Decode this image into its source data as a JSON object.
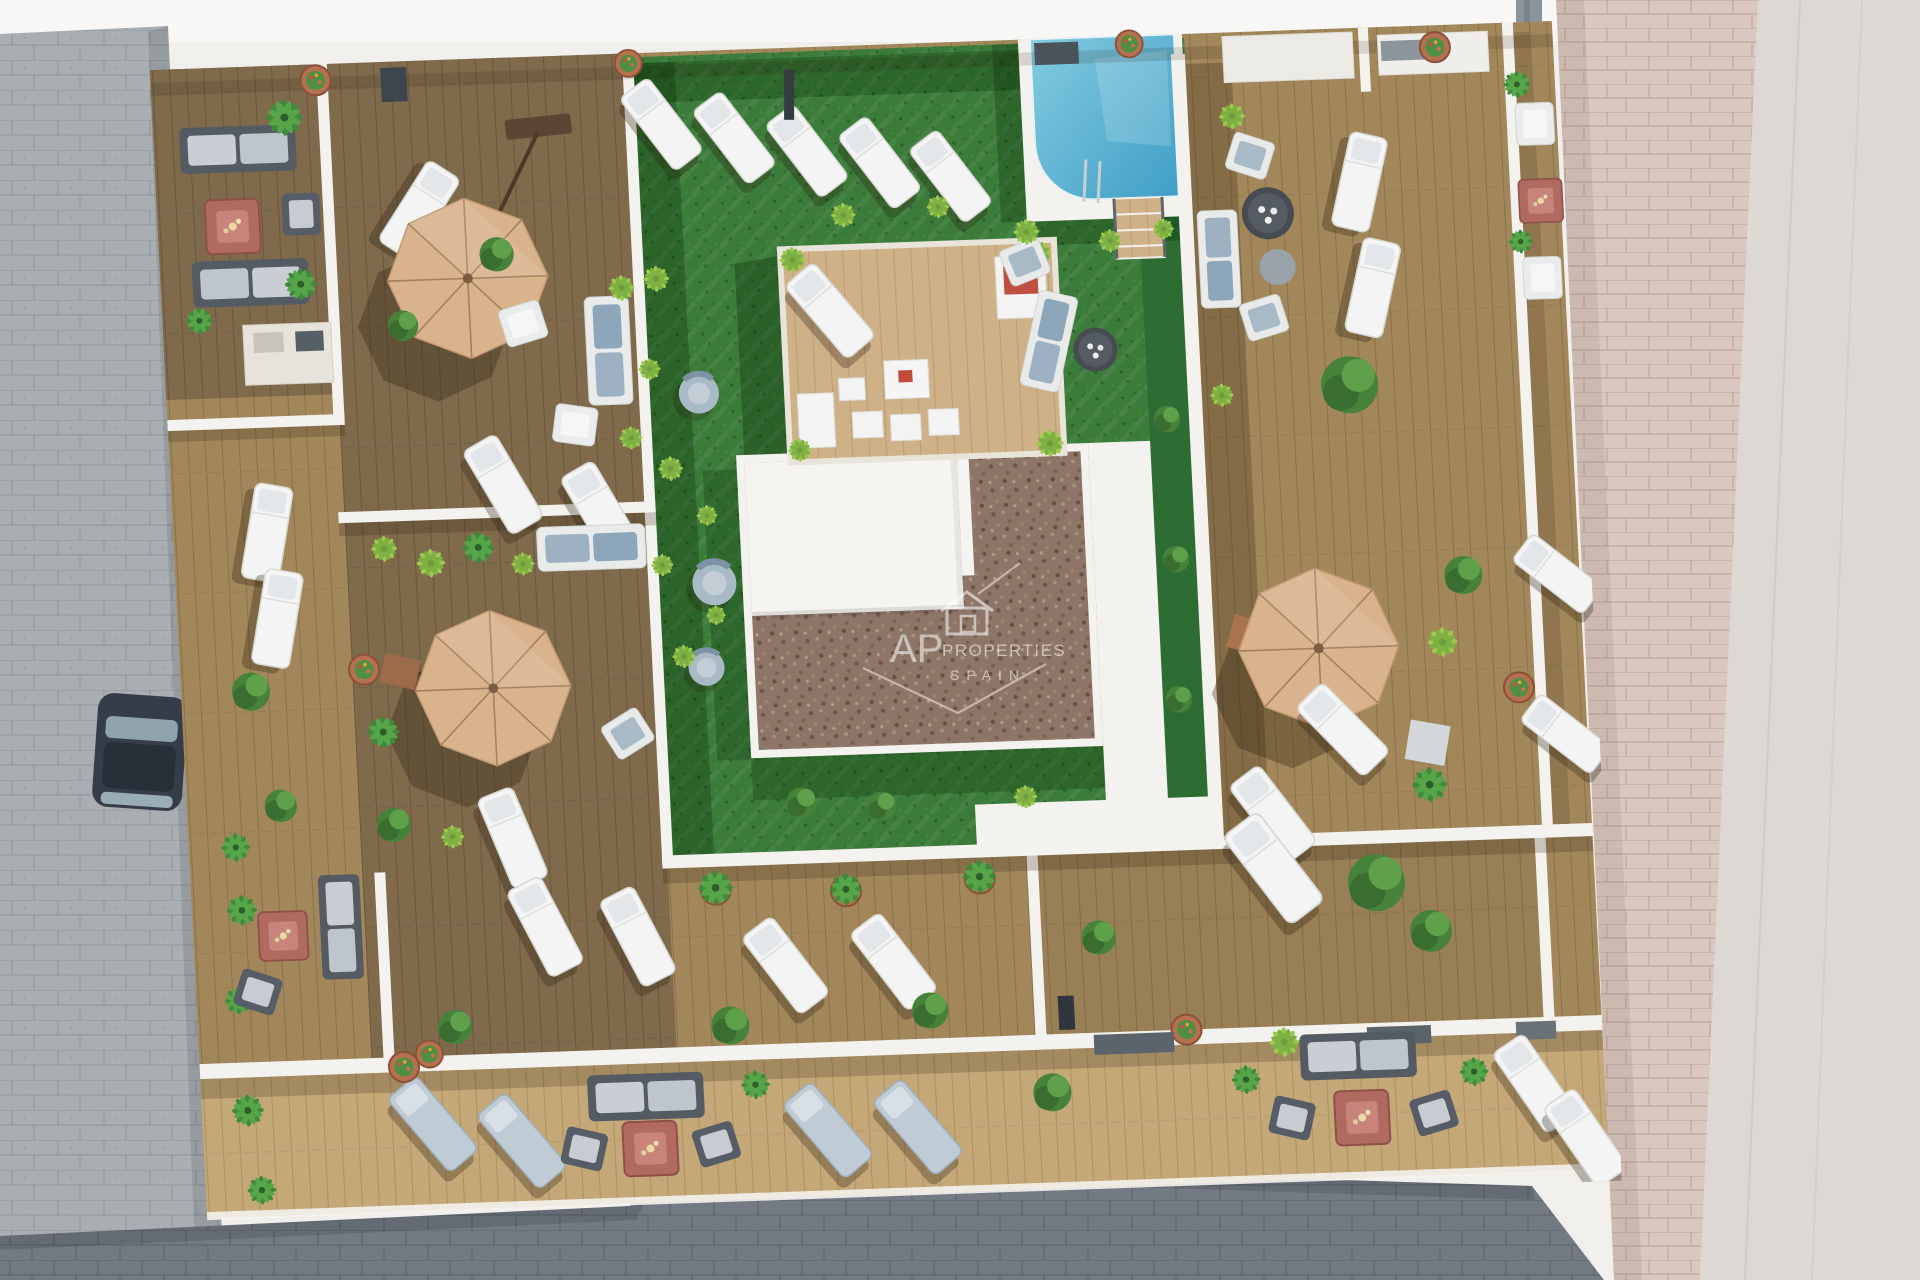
{
  "watermark": {
    "brand": "AP",
    "brand_suffix": "PROPERTIES",
    "country": "SPAIN",
    "icon": "house-outline-icon"
  },
  "palette": {
    "background": "#f1efec",
    "street_gray": "#a9aeb3",
    "street_dark": "#747a84",
    "path_pink": "#dac7bf",
    "sidewalk": "#dcd8d3",
    "wood_dark": "#7f6a4c",
    "wood_medium": "#a2875b",
    "wood_light": "#c4a878",
    "wood_pergola": "#cfb187",
    "grass": "#3c7c3a",
    "grass_dark": "#2d6c33",
    "pool_light": "#83cbe0",
    "pool_deep": "#3f9ec6",
    "wall_white": "#f4f2ee",
    "umbrella_tan": "#d9b38c",
    "gravel": "#8d7568",
    "fire_table": "#b06a5f",
    "furniture_white": "#f3f4f3",
    "furniture_blue": "#a9bac7",
    "plant_green": "#3f8a3b",
    "plant_bright": "#9ec94f",
    "pot_terracotta": "#b5714f"
  },
  "scene": {
    "view": "top-down aerial 3D render",
    "subject": "rooftop terraces with communal garden, pool and parasols",
    "parasol_count": 3,
    "pool_count": 1,
    "fire_table_count": 6,
    "approx_sun_loungers": 26
  }
}
